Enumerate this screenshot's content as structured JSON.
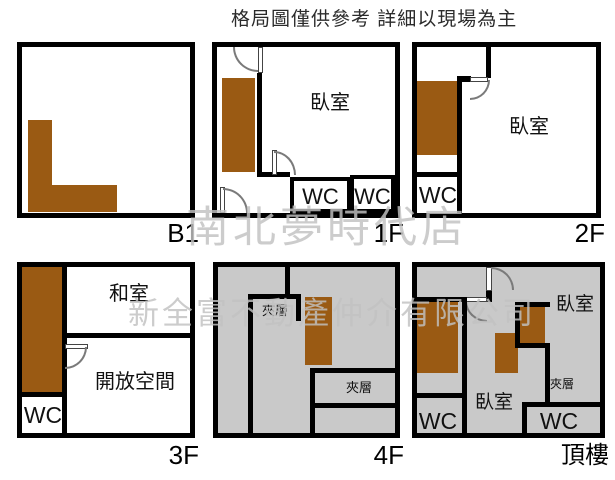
{
  "title": "格局圖僅供參考 詳細以現場為主",
  "watermarks": {
    "store": "南北夢時代店",
    "company": "新全富不動產仲介有限公司"
  },
  "colors": {
    "wall": "#000000",
    "stairs_brown": "#9a5a13",
    "mezzanine_gray": "#c9c9c9",
    "watermark_gray": "#c2c2c2"
  },
  "floors": {
    "b1": {
      "label": "B1"
    },
    "f1": {
      "label": "1F",
      "rooms": {
        "bedroom": "臥室",
        "wc_left": "WC",
        "wc_right": "WC"
      }
    },
    "f2": {
      "label": "2F",
      "rooms": {
        "bedroom": "臥室",
        "wc": "WC"
      }
    },
    "f3": {
      "label": "3F",
      "rooms": {
        "tatami": "和室",
        "open_space": "開放空間",
        "wc": "WC"
      }
    },
    "f4": {
      "label": "4F",
      "rooms": {
        "mezzanine_top": "夾層",
        "mezzanine_right": "夾層"
      }
    },
    "roof": {
      "label": "頂樓",
      "rooms": {
        "bedroom_right": "臥室",
        "bedroom_center": "臥室",
        "mezzanine": "夾層",
        "wc_left": "WC",
        "wc_right": "WC"
      }
    }
  }
}
